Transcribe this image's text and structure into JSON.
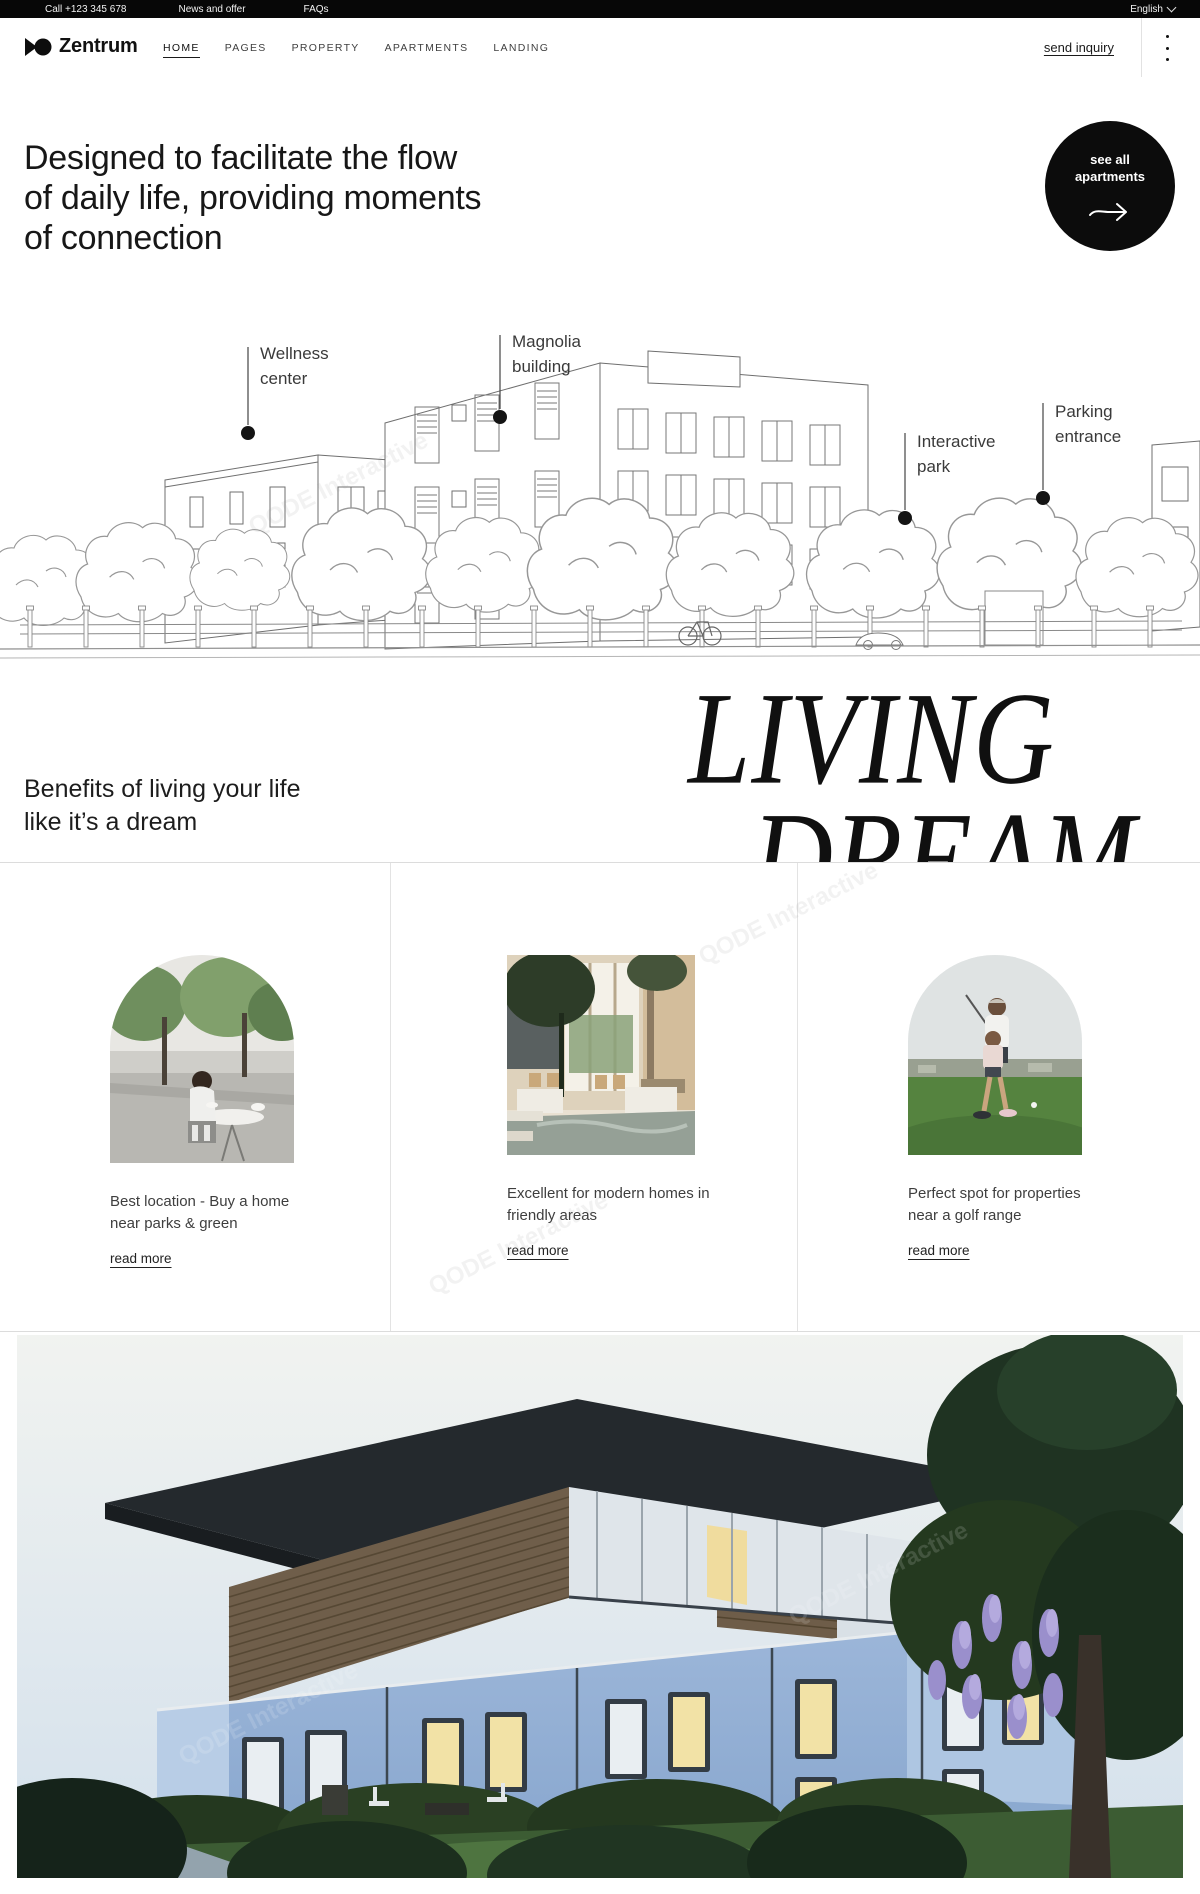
{
  "watermark": {
    "text": "QODE Interactive"
  },
  "topbar": {
    "phone": "Call +123 345 678",
    "news": "News and offer",
    "faqs": "FAQs",
    "language": "English"
  },
  "nav": {
    "brand": "Zentrum",
    "items": [
      "HOME",
      "PAGES",
      "PROPERTY",
      "APARTMENTS",
      "LANDING"
    ],
    "inquiry": "send inquiry"
  },
  "hero": {
    "line1": "Designed to facilitate the flow",
    "line2": "of daily life, providing moments",
    "line3": "of connection",
    "cta": {
      "line1": "see all",
      "line2": "apartments"
    }
  },
  "illustration": {
    "labels": [
      {
        "line1": "Wellness",
        "line2": "center"
      },
      {
        "line1": "Magnolia",
        "line2": "building"
      },
      {
        "line1": "Interactive",
        "line2": "park"
      },
      {
        "line1": "Parking",
        "line2": "entrance"
      }
    ]
  },
  "benefits": {
    "line1": "Benefits of living your life",
    "line2": "like it’s a dream",
    "display_word1": "LIVING",
    "display_word2": "DREAM",
    "cards": [
      {
        "title_line1": "Best location - Buy a home",
        "title_line2": "near parks & green",
        "link": "read more"
      },
      {
        "title_line1": "Excellent for modern homes in",
        "title_line2": "friendly areas",
        "link": "read more"
      },
      {
        "title_line1": "Perfect spot for properties",
        "title_line2": "near a golf range",
        "link": "read more"
      }
    ]
  },
  "colors": {
    "topbar_bg": "#070707",
    "cta_bg": "#0c0c0c",
    "accent_text": "#171717",
    "building_blue": "#9cb6d9"
  }
}
